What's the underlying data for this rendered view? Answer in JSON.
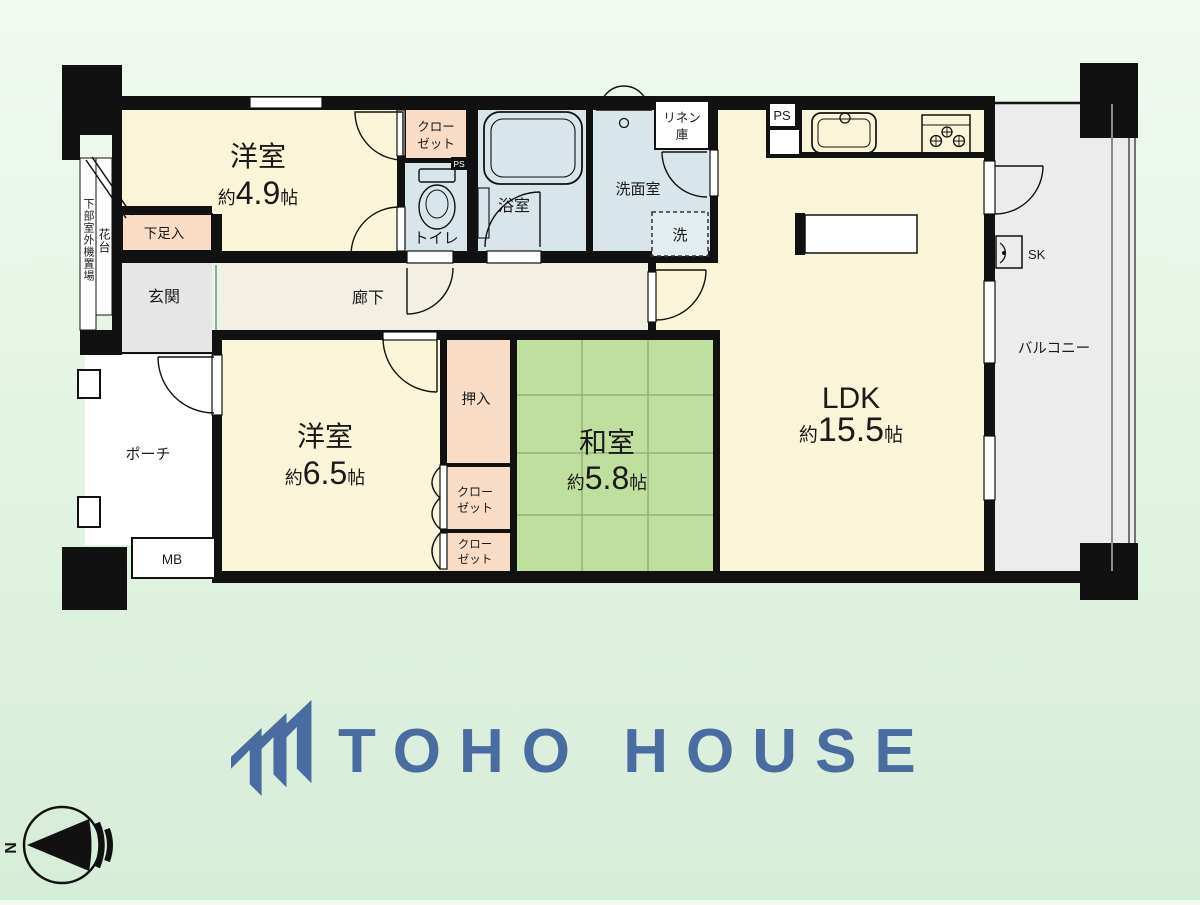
{
  "plan": {
    "rooms": {
      "yoshitsu1": {
        "name": "洋室",
        "approx": "約",
        "area": "4.9",
        "unit": "帖"
      },
      "yoshitsu2": {
        "name": "洋室",
        "approx": "約",
        "area": "6.5",
        "unit": "帖"
      },
      "washitsu": {
        "name": "和室",
        "approx": "約",
        "area": "5.8",
        "unit": "帖"
      },
      "ldk": {
        "name": "LDK",
        "approx": "約",
        "area": "15.5",
        "unit": "帖"
      }
    },
    "labels": {
      "genkan": "玄関",
      "rouka": "廊下",
      "porch": "ポーチ",
      "balcony": "バルコニー",
      "bath": "浴室",
      "washroom": "洗面室",
      "toilet": "トイレ",
      "oshiire": "押入",
      "shoe_cabinet": "下足入",
      "flower_stand": "花台",
      "outdoor_unit": "下部室外機置場",
      "linen_line1": "リネン",
      "linen_line2": "庫",
      "laundry": "洗",
      "closet_line1": "クロー",
      "closet_line2": "ゼット",
      "mb": "MB",
      "ps": "PS",
      "ps_small": "PS",
      "sk": "SK"
    },
    "compass": {
      "north": "N"
    }
  },
  "logo": {
    "text": "TOHO HOUSE"
  },
  "colors": {
    "room_cream": "#faf5d8",
    "tatami_green": "#bfdf9e",
    "tatami_line": "#93b478",
    "water_blue": "#d8e6eb",
    "closet_pink": "#f8dcc6",
    "entry_gray": "#e6e6e6",
    "corridor_beige": "#f4efe3",
    "porch_white": "#ffffff",
    "balcony_gray": "#ececec",
    "wall_black": "#111111",
    "logo_blue": "#4a6ca0"
  }
}
